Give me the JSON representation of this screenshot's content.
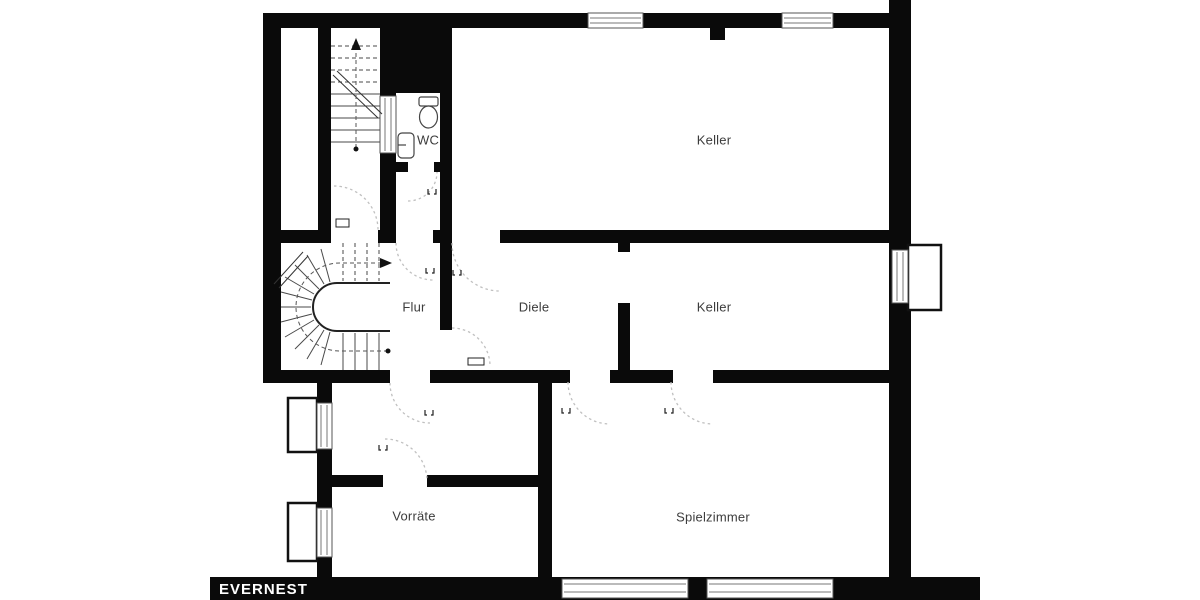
{
  "meta": {
    "type": "floor-plan",
    "level": "basement"
  },
  "brand": {
    "name": "EVERNEST"
  },
  "rooms": [
    {
      "id": "wc",
      "label": "WC"
    },
    {
      "id": "keller-top",
      "label": "Keller"
    },
    {
      "id": "flur",
      "label": "Flur"
    },
    {
      "id": "diele",
      "label": "Diele"
    },
    {
      "id": "keller-mid",
      "label": "Keller"
    },
    {
      "id": "vorraete",
      "label": "Vorräte"
    },
    {
      "id": "spielzimmer",
      "label": "Spielzimmer"
    }
  ],
  "icons": [
    "toilet-icon",
    "sink-icon",
    "staircase-straight-icon",
    "staircase-winder-icon",
    "door-arc-icon",
    "door-leaf-icon",
    "door-stop-icon",
    "window-icon",
    "lightwell-icon",
    "up-arrow-icon"
  ],
  "colors": {
    "wall": "#0a0a0a",
    "background": "#ffffff",
    "label_text": "#3c3c3c",
    "logo_text": "#ffffff",
    "door_arc": "#c0c0c0",
    "stair_line": "#4a4a4a",
    "window_line": "#777777"
  }
}
